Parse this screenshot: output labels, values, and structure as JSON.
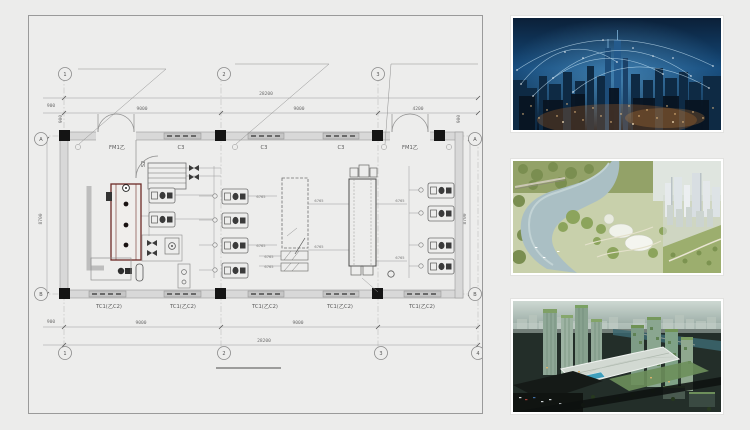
{
  "plan": {
    "grid_bubbles": {
      "top": [
        "1",
        "2",
        "3"
      ],
      "bottom": [
        "1",
        "2",
        "3",
        "4"
      ],
      "left": [
        "A",
        "B"
      ],
      "right": [
        "A",
        "B"
      ]
    },
    "dimensions": {
      "top_total": "28200",
      "top_segments": [
        "9000",
        "9000",
        "4200"
      ],
      "bottom_segments": [
        "9000",
        "9000"
      ],
      "bottom_total": "28200",
      "side_small": "900",
      "bottom_small": "900",
      "wall_small": "900",
      "left_height": "8700",
      "right_height": "8700"
    },
    "labels": {
      "door": "FM1乙",
      "window_top": "C3",
      "window_bottom": "TC1(乙C2)",
      "partition": "S2",
      "pipe": "6765"
    },
    "colors": {
      "line": "#8f8f8f",
      "wall_fill": "#d8d8d8",
      "column": "#141414",
      "equipment_accent": "#6d2a26"
    }
  },
  "gallery": {
    "items": [
      {
        "name": "smart-city-night-photo",
        "palette": [
          "#0b2038",
          "#14497a",
          "#081525",
          "#ffcf8d",
          "#d6f1ff"
        ]
      },
      {
        "name": "riverfront-masterplan-render",
        "palette": [
          "#c8d0ab",
          "#93a268",
          "#a9bec3",
          "#f0f2ea",
          "#dfe5e8"
        ]
      },
      {
        "name": "mixed-use-towers-render",
        "palette": [
          "#cdd8d2",
          "#232e29",
          "#8ea796",
          "#7fa066",
          "#3f9fbc"
        ]
      }
    ]
  }
}
